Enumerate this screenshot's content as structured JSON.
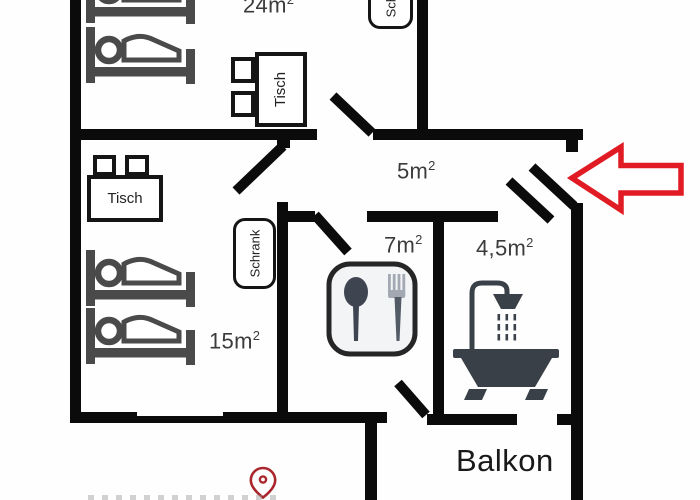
{
  "rooms": {
    "bedroom_large": {
      "area": "24m",
      "sup": "2"
    },
    "hallway": {
      "area": "5m",
      "sup": "2"
    },
    "kitchen": {
      "area": "7m",
      "sup": "2"
    },
    "bathroom": {
      "area": "4,5m",
      "sup": "2"
    },
    "bedroom_small": {
      "area": "15m",
      "sup": "2"
    },
    "balcony": {
      "label": "Balkon"
    }
  },
  "furniture": {
    "table_top": {
      "label": "Tisch"
    },
    "table_left": {
      "label": "Tisch"
    },
    "wardrobe_top": {
      "label": "Schrank"
    },
    "wardrobe_mid": {
      "label": "Schrank"
    }
  },
  "icons": {
    "beds": "bunk-bed-icon",
    "kitchen": "cutlery-icon",
    "bathroom": "bathtub-shower-icon",
    "entrance": "entrance-arrow-icon",
    "pin": "location-pin-icon",
    "chairs": "chair-icon"
  },
  "colors": {
    "wall": "#0b0b0b",
    "furniture_gray": "#4a4a4a",
    "fixture_gray": "#3a4048",
    "arrow_red": "#e11b23",
    "pin_red": "#a8262c",
    "label_text": "#3b3b3b"
  }
}
